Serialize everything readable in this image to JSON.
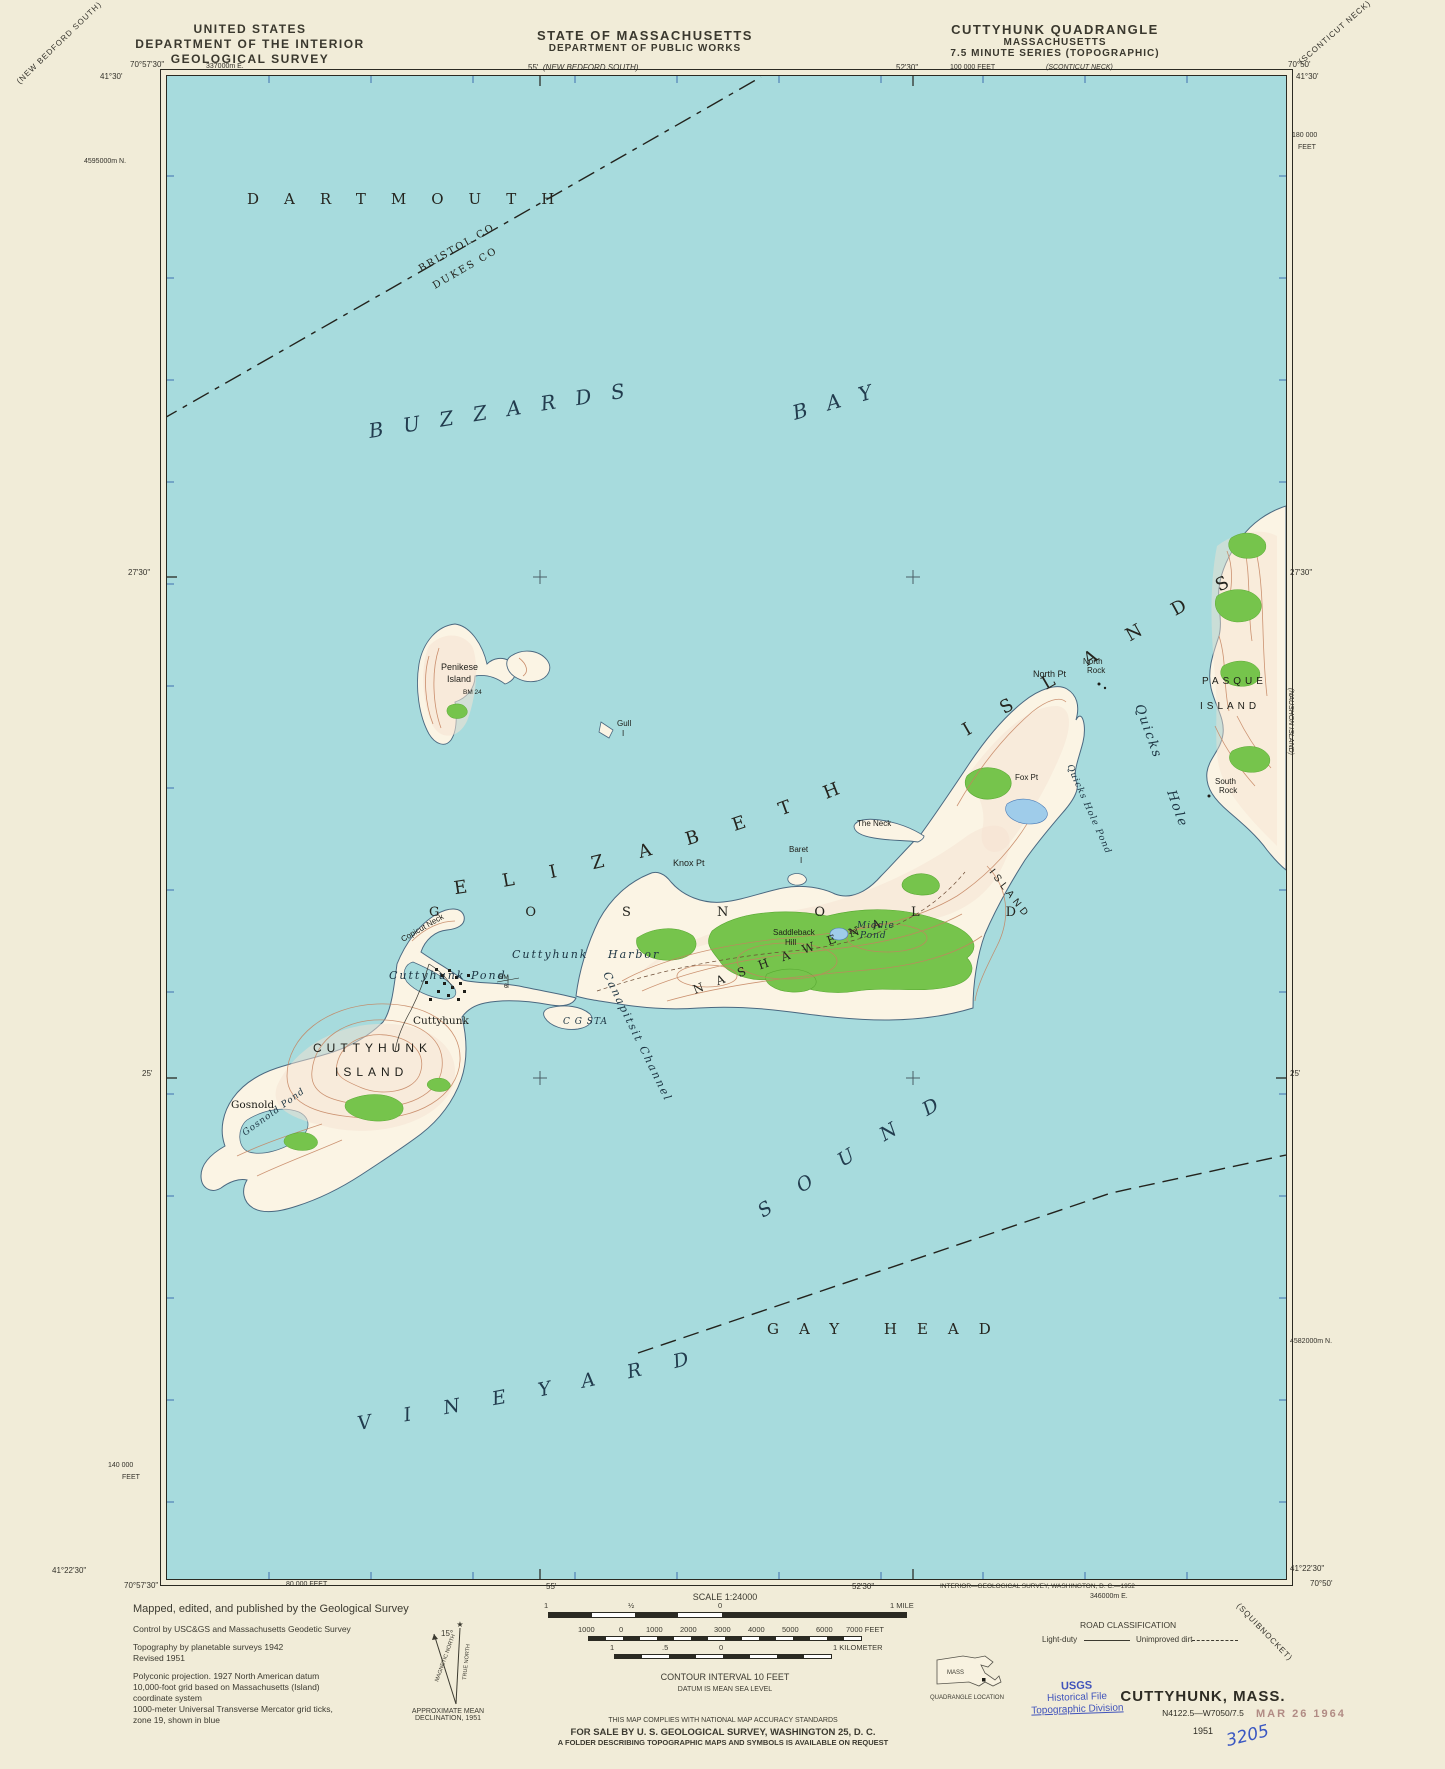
{
  "header": {
    "left": [
      "UNITED STATES",
      "DEPARTMENT OF THE INTERIOR",
      "GEOLOGICAL SURVEY"
    ],
    "center": [
      "STATE OF MASSACHUSETTS",
      "DEPARTMENT OF PUBLIC WORKS"
    ],
    "right": [
      "CUTTYHUNK QUADRANGLE",
      "MASSACHUSETTS",
      "7.5 MINUTE SERIES (TOPOGRAPHIC)"
    ]
  },
  "margin": {
    "top": {
      "lon_left": "70°57'30\"",
      "lat_left": "41°30'",
      "utm_e": "337000m E.",
      "min55": "55'",
      "adj_north": "(NEW BEDFORD SOUTH)",
      "min5230": "52'30\"",
      "feet": "100 000 FEET",
      "adj_ne": "(SCONTICUT NECK)",
      "lon_right": "70°50'",
      "lat_right": "41°30'",
      "diag_nw": "(NEW BEDFORD SOUTH)",
      "diag_ne": "(SCONTICUT NECK)"
    },
    "left": {
      "utm_n": "4595000m N.",
      "min2730": "27'30\"",
      "min25": "25'",
      "feet1": "140 000",
      "feet2": "FEET",
      "lat_bl": "41°22'30\"",
      "lon_bl": "70°57'30\""
    },
    "right": {
      "feet1": "180 000",
      "feet2": "FEET",
      "min2730": "27'30\"",
      "adj_e": "(NAUSHON ISLAND)",
      "min25": "25'",
      "utm_n": "4582000m N.",
      "lat_br": "41°22'30\"",
      "lon_br": "70°50'",
      "diag_se": "(SQUIBNOCKET)"
    },
    "bottom": {
      "feet": "80 000 FEET",
      "min55": "55'",
      "min5230": "52'30\"",
      "credit": "INTERIOR—GEOLOGICAL SURVEY, WASHINGTON, D. C.—1952",
      "utm_e": "346000m E."
    }
  },
  "map": {
    "labels": {
      "town_dartmouth": "DARTMOUTH",
      "county1": "BRISTOL CO",
      "county2": "DUKES CO",
      "buzzards": "BUZZARDS",
      "bay": "BAY",
      "elizabeth": "ELIZABETH",
      "islands": "ISLANDS",
      "penikese1": "Penikese",
      "penikese2": "Island",
      "bm24": "BM 24",
      "gull": "Gull",
      "gull_i": "I",
      "north_pt": "North Pt",
      "north_rock1": "North",
      "north_rock2": "Rock",
      "pasque1": "PASQUE",
      "pasque2": "ISLAND",
      "south_rock1": "South",
      "south_rock2": "Rock",
      "quicks": "Quicks",
      "hole": "Hole",
      "the_neck": "The Neck",
      "baret": "Baret",
      "baret_i": "I",
      "knox_pt": "Knox Pt",
      "gosnold_town": "GOSNOLD",
      "nashawena": "NASHAWENA",
      "nashawena_island": "ISLAND",
      "saddleback1": "Saddleback",
      "saddleback2": "Hill",
      "spot33": "33",
      "middle1": "Middle",
      "middle2": "Pond",
      "quicks_hole_pond": "Quicks Hole Pond",
      "fox_pt": "Fox Pt",
      "copicut": "Copicut Neck",
      "harbor": "Cuttyhunk Harbor",
      "cpond": "Cuttyhunk Pond",
      "canapitsit": "Canapitsit Channel",
      "cg_sta": "C G STA",
      "bm": "BM",
      "bm6": "6",
      "cuttyhunk_village": "Cuttyhunk",
      "cuttyhunk1": "CUTTYHUNK",
      "cuttyhunk2": "ISLAND",
      "gosnold_village": "Gosnold",
      "gosnold_pond": "Gosnold Pond",
      "vineyard": "VINEYARD",
      "sound": "SOUND",
      "gay_head": "GAY HEAD"
    }
  },
  "footer": {
    "credits": [
      "Mapped, edited, and published by the Geological Survey",
      "Control by USC&GS and Massachusetts Geodetic Survey",
      "Topography by planetable surveys 1942",
      "Revised 1951",
      "Polyconic projection.    1927 North American datum",
      "10,000-foot grid based on Massachusetts (Island)",
      "coordinate system",
      "1000-meter Universal Transverse Mercator grid ticks,",
      "zone 19, shown in blue"
    ],
    "declination": {
      "angle": "15°",
      "magnetic": "MAGNETIC NORTH",
      "truen": "TRUE NORTH",
      "cap1": "APPROXIMATE MEAN",
      "cap2": "DECLINATION, 1951"
    },
    "scale": {
      "title": "SCALE 1:24000",
      "mile": [
        "1",
        "½",
        "0",
        "1 MILE"
      ],
      "feet": [
        "1000",
        "0",
        "1000",
        "2000",
        "3000",
        "4000",
        "5000",
        "6000",
        "7000 FEET"
      ],
      "km": [
        "1",
        ".5",
        "0",
        "1 KILOMETER"
      ],
      "contour": "CONTOUR INTERVAL 10 FEET",
      "datum": "DATUM IS MEAN SEA LEVEL"
    },
    "notes": [
      "THIS MAP COMPLIES WITH NATIONAL MAP ACCURACY STANDARDS",
      "FOR SALE BY U. S. GEOLOGICAL SURVEY, WASHINGTON 25, D. C.",
      "A FOLDER DESCRIBING TOPOGRAPHIC MAPS AND SYMBOLS IS AVAILABLE ON REQUEST"
    ],
    "roads": {
      "title": "ROAD CLASSIFICATION",
      "light": "Light-duty",
      "dirt": "Unimproved dirt"
    },
    "location": {
      "state": "MASS",
      "caption": "QUADRANGLE LOCATION"
    },
    "stamp": [
      "USGS",
      "Historical File",
      "Topographic Division"
    ],
    "title_block": {
      "name": "CUTTYHUNK, MASS.",
      "code": "N4122.5—W7050/7.5",
      "year": "1951"
    },
    "received": "MAR 26 1964",
    "hand": "3205"
  }
}
